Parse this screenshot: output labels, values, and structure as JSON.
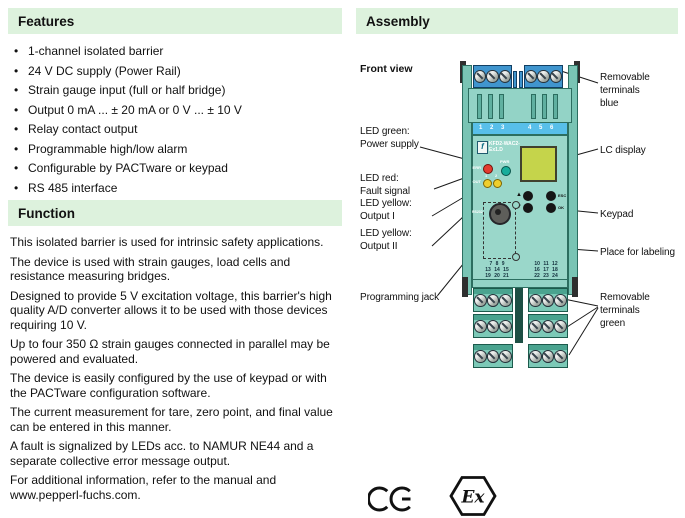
{
  "colors": {
    "header_bg": "#ddf2dd",
    "device_body": "#9ad7ca",
    "device_housing": "#93d3c6",
    "top_band_blue": "#58bfe9",
    "terminal_blue": "#4095ce",
    "terminal_green": "#7cc9b7",
    "lc_display": "#c5d44b",
    "led_red": "#e33b2e",
    "led_green": "#17ad9b",
    "led_yellow": "#efcf2c"
  },
  "features": {
    "title": "Features",
    "items": [
      "1-channel isolated barrier",
      "24 V DC supply (Power Rail)",
      "Strain gauge input (full or half bridge)",
      "Output 0 mA ... ± 20 mA or 0 V ... ± 10 V",
      "Relay contact output",
      "Programmable high/low alarm",
      "Configurable by PACTware or keypad",
      "RS 485 interface",
      "Line fault detection (LFD)"
    ]
  },
  "function_section": {
    "title": "Function",
    "paragraphs": [
      "This isolated barrier is used for intrinsic safety applications.",
      "The device is used with strain gauges, load cells and resistance measuring bridges.",
      "Designed to provide 5 V excitation voltage, this barrier's high quality A/D converter allows it to be used with those devices requiring 10 V.",
      "Up to four 350 Ω strain gauges connected in parallel may be powered and evaluated.",
      "The device is easily configured by the use of keypad or with the PACTware configuration software.",
      "The current measurement for tare, zero point, and final value can be entered in this manner.",
      "A fault is signalized by LEDs acc. to NAMUR NE44 and a separate collective error message output.",
      "For additional information, refer to the manual and www.pepperl-fuchs.com."
    ]
  },
  "assembly": {
    "title": "Assembly",
    "front_view": "Front view",
    "labels": {
      "led_green_1": "LED green:",
      "led_green_2": "Power supply",
      "led_red_1": "LED red:",
      "led_red_2": "Fault signal",
      "led_yellow1_1": "LED yellow:",
      "led_yellow1_2": "Output I",
      "led_yellow2_1": "LED yellow:",
      "led_yellow2_2": "Output II",
      "prog_jack": "Programming jack",
      "term_blue_1": "Removable terminals",
      "term_blue_2": "blue",
      "lc_display": "LC display",
      "keypad": "Keypad",
      "labeling": "Place for labeling",
      "term_green_1": "Removable terminals",
      "term_green_2": "green"
    },
    "device": {
      "top_left": "1 2 3",
      "top_right": "4 5 6",
      "logo_glyph": "f",
      "model_1": "KFD2-WAC2-",
      "model_2": "Ex1.D",
      "pwr": "PWR",
      "err": "ERR",
      "out": "OUT",
      "out_1": "1",
      "out_2": "2",
      "up": "▲",
      "down": "▼",
      "esc": "ESC",
      "ok": "OK",
      "jack_text": "RS232",
      "bottom_left": [
        "7 8 9",
        "13 14 15",
        "19 20 21"
      ],
      "bottom_right": [
        "10 11 12",
        "16 17 18",
        "22 23 24"
      ]
    }
  },
  "marks": {
    "ce": "CE",
    "ex": "Ex"
  }
}
